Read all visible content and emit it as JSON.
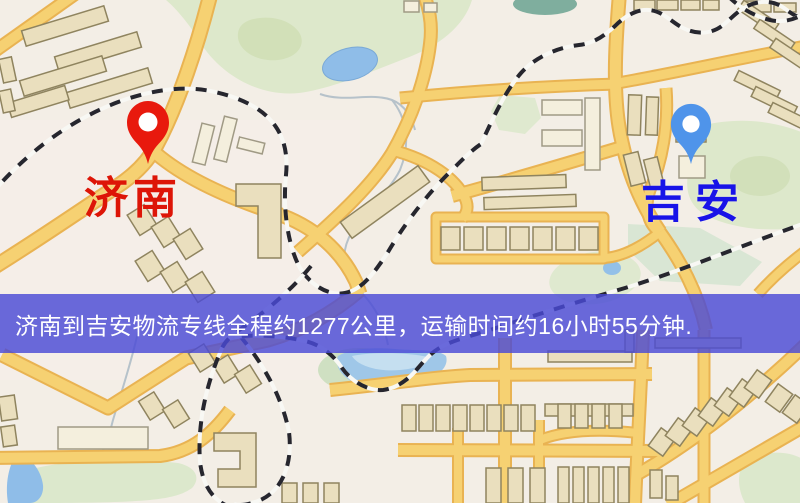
{
  "map": {
    "origin": {
      "name": "济南",
      "pin_color": "#e8190d",
      "label_color": "#dd1507"
    },
    "destination": {
      "name": "吉安",
      "pin_color": "#4f94ea",
      "label_color": "#1813e8"
    },
    "banner": {
      "text": "济南到吉安物流专线全程约1277公里，运输时间约16小时55分钟.",
      "background_color": "#4a4ad6",
      "text_color": "#ffffff"
    }
  },
  "palette": {
    "map_background": "#f3eee6",
    "road_fill": "#f6d172",
    "road_casing": "#e9b352",
    "building_fill": "#eadfbe",
    "building_stroke": "#8f845f",
    "park_green": "#dde8cb",
    "water_blue": "#8fbde8",
    "railway_dark": "#26262e"
  }
}
